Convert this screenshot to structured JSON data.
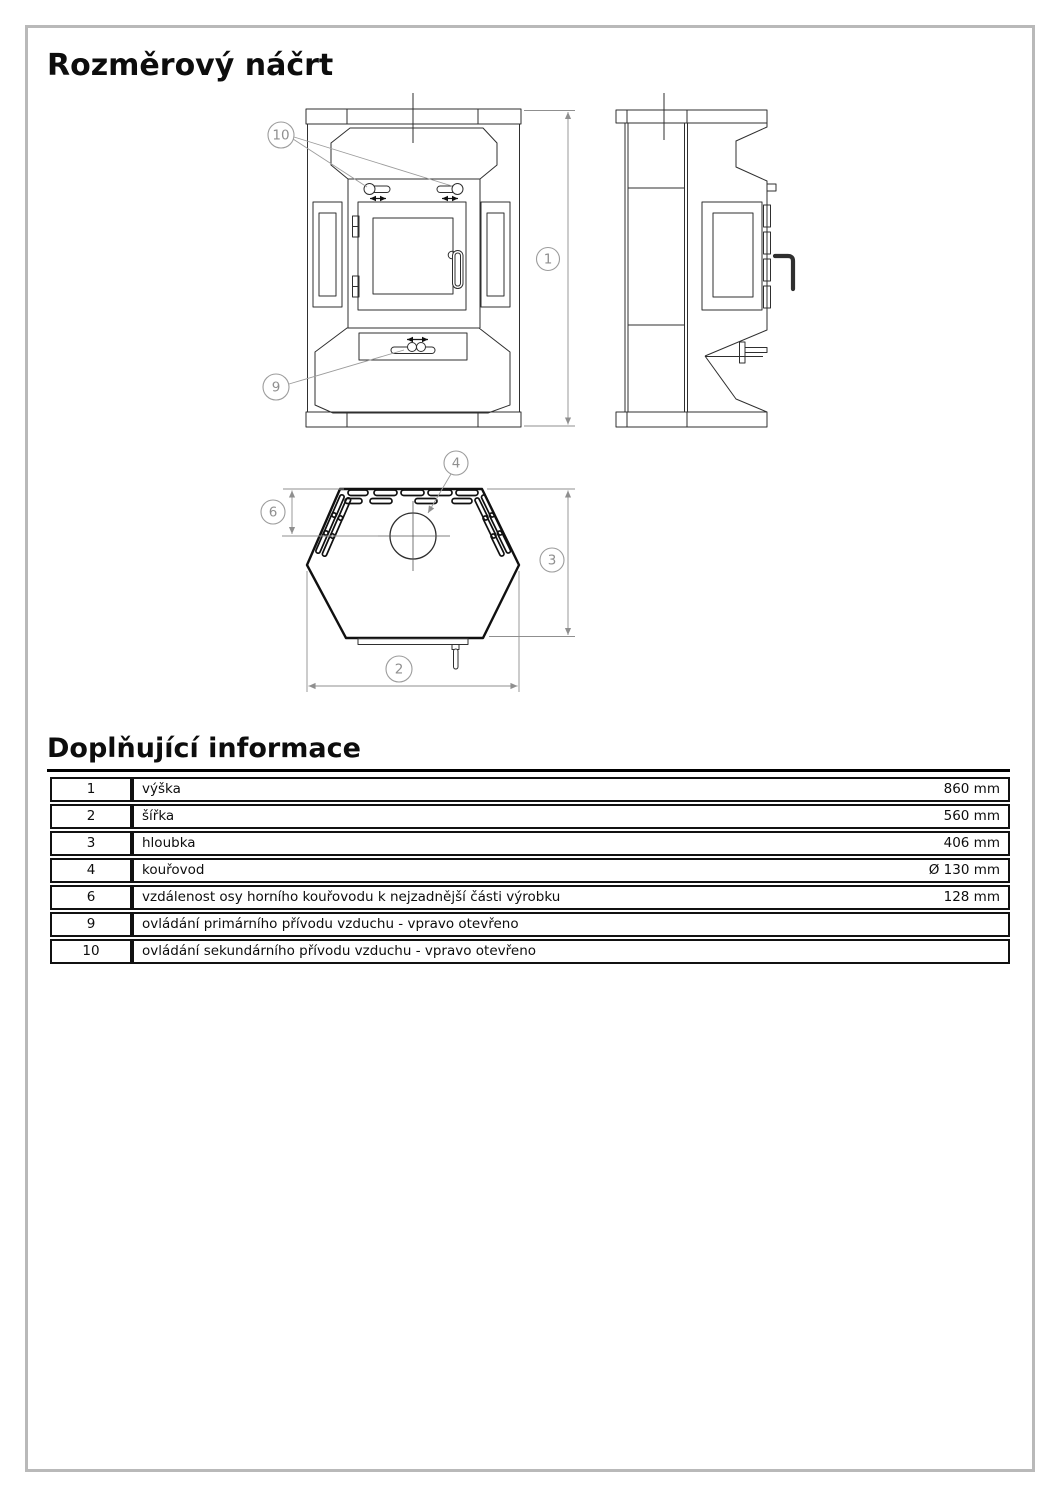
{
  "document": {
    "title": "Rozměrový náčrt",
    "section_title": "Doplňující informace"
  },
  "drawing": {
    "callouts": {
      "height": "1",
      "width": "2",
      "depth": "3",
      "flue": "4",
      "flue_offset": "6",
      "primary_air": "9",
      "secondary_air": "10"
    }
  },
  "info_table": {
    "rows": [
      {
        "num": "1",
        "label": "výška",
        "value": "860 mm"
      },
      {
        "num": "2",
        "label": "šířka",
        "value": "560 mm"
      },
      {
        "num": "3",
        "label": "hloubka",
        "value": "406 mm"
      },
      {
        "num": "4",
        "label": "kouřovod",
        "value": "Ø 130 mm"
      },
      {
        "num": "6",
        "label": "vzdálenost osy horního kouřovodu k nejzadnější části výrobku",
        "value": "128 mm"
      },
      {
        "num": "9",
        "label": "ovládání primárního přívodu vzduchu - vpravo otevřeno",
        "value": ""
      },
      {
        "num": "10",
        "label": "ovládání sekundárního přívodu vzduchu - vpravo otevřeno",
        "value": ""
      }
    ]
  }
}
